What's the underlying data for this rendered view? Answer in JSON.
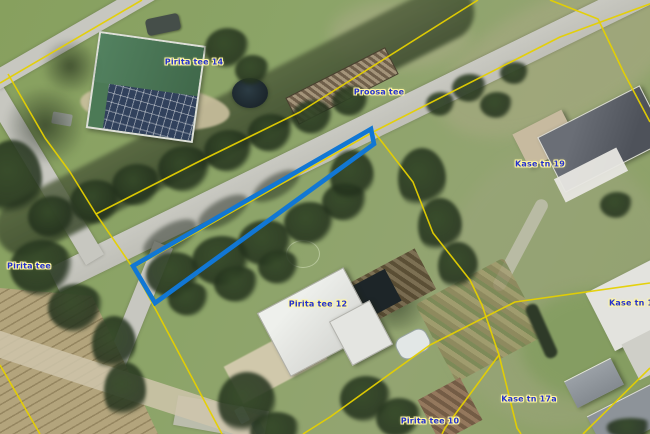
{
  "map": {
    "type": "aerial-cadastral-map",
    "labels": [
      {
        "text": "Pirita tee 14",
        "x": 194,
        "y": 62
      },
      {
        "text": "Proosa tee",
        "x": 379,
        "y": 92
      },
      {
        "text": "Kase tn 19",
        "x": 540,
        "y": 164
      },
      {
        "text": "Pirita tee",
        "x": 29,
        "y": 266
      },
      {
        "text": "Pirita tee 12",
        "x": 318,
        "y": 304
      },
      {
        "text": "Kase tn 17",
        "x": 609,
        "y": 303
      },
      {
        "text": "Kase tn 17a",
        "x": 529,
        "y": 399
      },
      {
        "text": "Pirita tee 10",
        "x": 430,
        "y": 421
      }
    ],
    "colors": {
      "parcel_boundary": "#e5d000",
      "highlight_parcel": "#1177d4",
      "label_text": "#2633cd",
      "label_halo": "#fff6a0"
    },
    "highlighted_parcel": {
      "points": "371,129 374,144 155,303 133,266"
    }
  }
}
